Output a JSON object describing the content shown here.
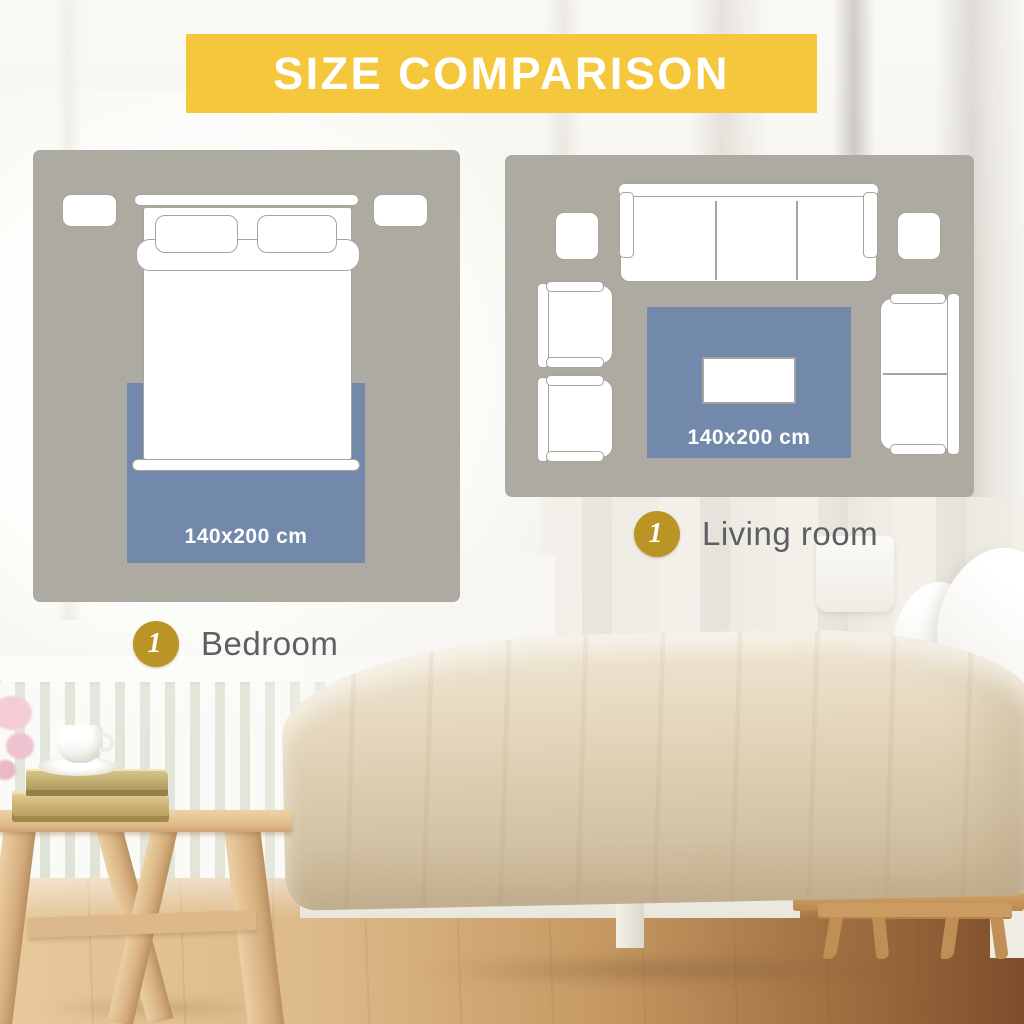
{
  "title": "SIZE COMPARISON",
  "panels": {
    "bedroom": {
      "name": "Bedroom",
      "badge_number": "1",
      "rug_size": "140x200 cm"
    },
    "living_room": {
      "name": "Living room",
      "badge_number": "1",
      "rug_size": "140x200 cm"
    }
  },
  "colors": {
    "banner_yellow": "#F5C73C",
    "rug_blue": "#7289AB",
    "badge_gold": "#BA9526",
    "panel_gray": "#ADAAA1",
    "outline_gray": "#A7A49B",
    "legend_text_gray": "#5D5F62"
  }
}
